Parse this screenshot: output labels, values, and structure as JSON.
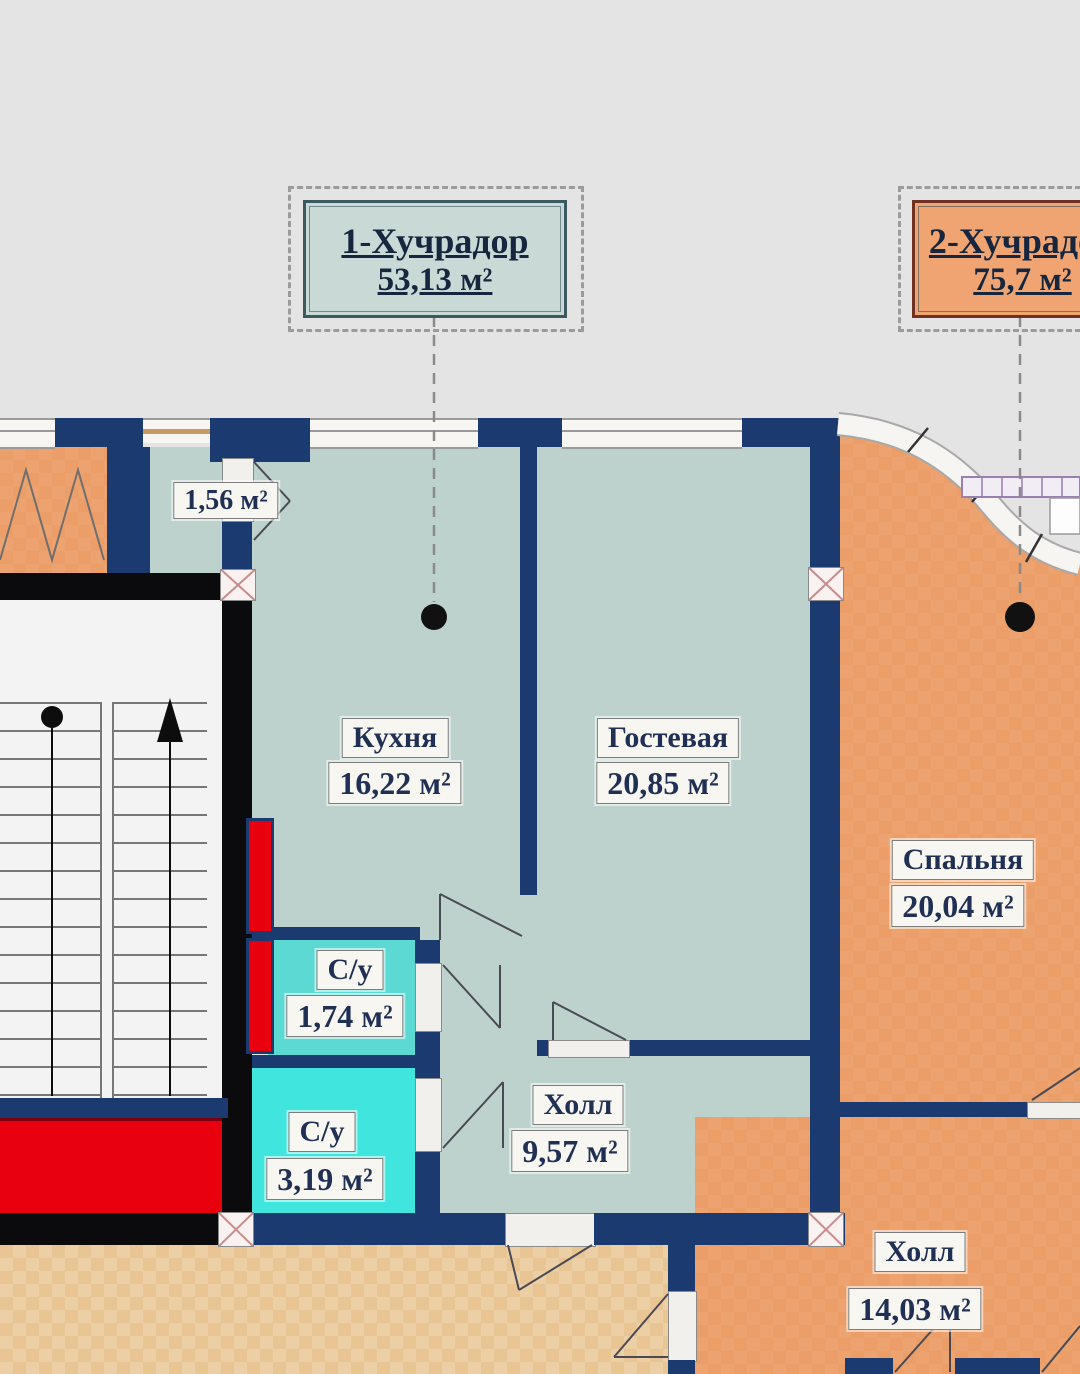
{
  "plan": {
    "apartment_labels": [
      {
        "title": "1-Хучрадор",
        "area": "53,13 м²"
      },
      {
        "title": "2-Хучрадор",
        "area": "75,7 м²"
      }
    ],
    "rooms": {
      "balcony": {
        "area": "1,56 м²"
      },
      "kitchen": {
        "name": "Кухня",
        "area": "16,22 м²"
      },
      "living": {
        "name": "Гостевая",
        "area": "20,85 м²"
      },
      "bedroom": {
        "name": "Спальня",
        "area": "20,04 м²"
      },
      "wc1": {
        "name": "С/у",
        "area": "1,74 м²"
      },
      "wc2": {
        "name": "С/у",
        "area": "3,19 м²"
      },
      "hall1": {
        "name": "Холл",
        "area": "9,57 м²"
      },
      "hall2": {
        "name": "Холл",
        "area": "14,03 м²"
      }
    },
    "colors": {
      "bg": "#e5e4e5",
      "apt1_room": "#bdd2cd",
      "apt2_room": "#eb9e67",
      "wc1": "#5cd9d3",
      "wc2": "#40e6de",
      "wall_navy": "#1b3a70",
      "wall_black": "#0b0b0e",
      "shaft_red": "#e8000f",
      "corridor": "#e9c593",
      "label_box1_fill": "#c9d9d5",
      "label_box2_fill": "#efa472"
    }
  }
}
